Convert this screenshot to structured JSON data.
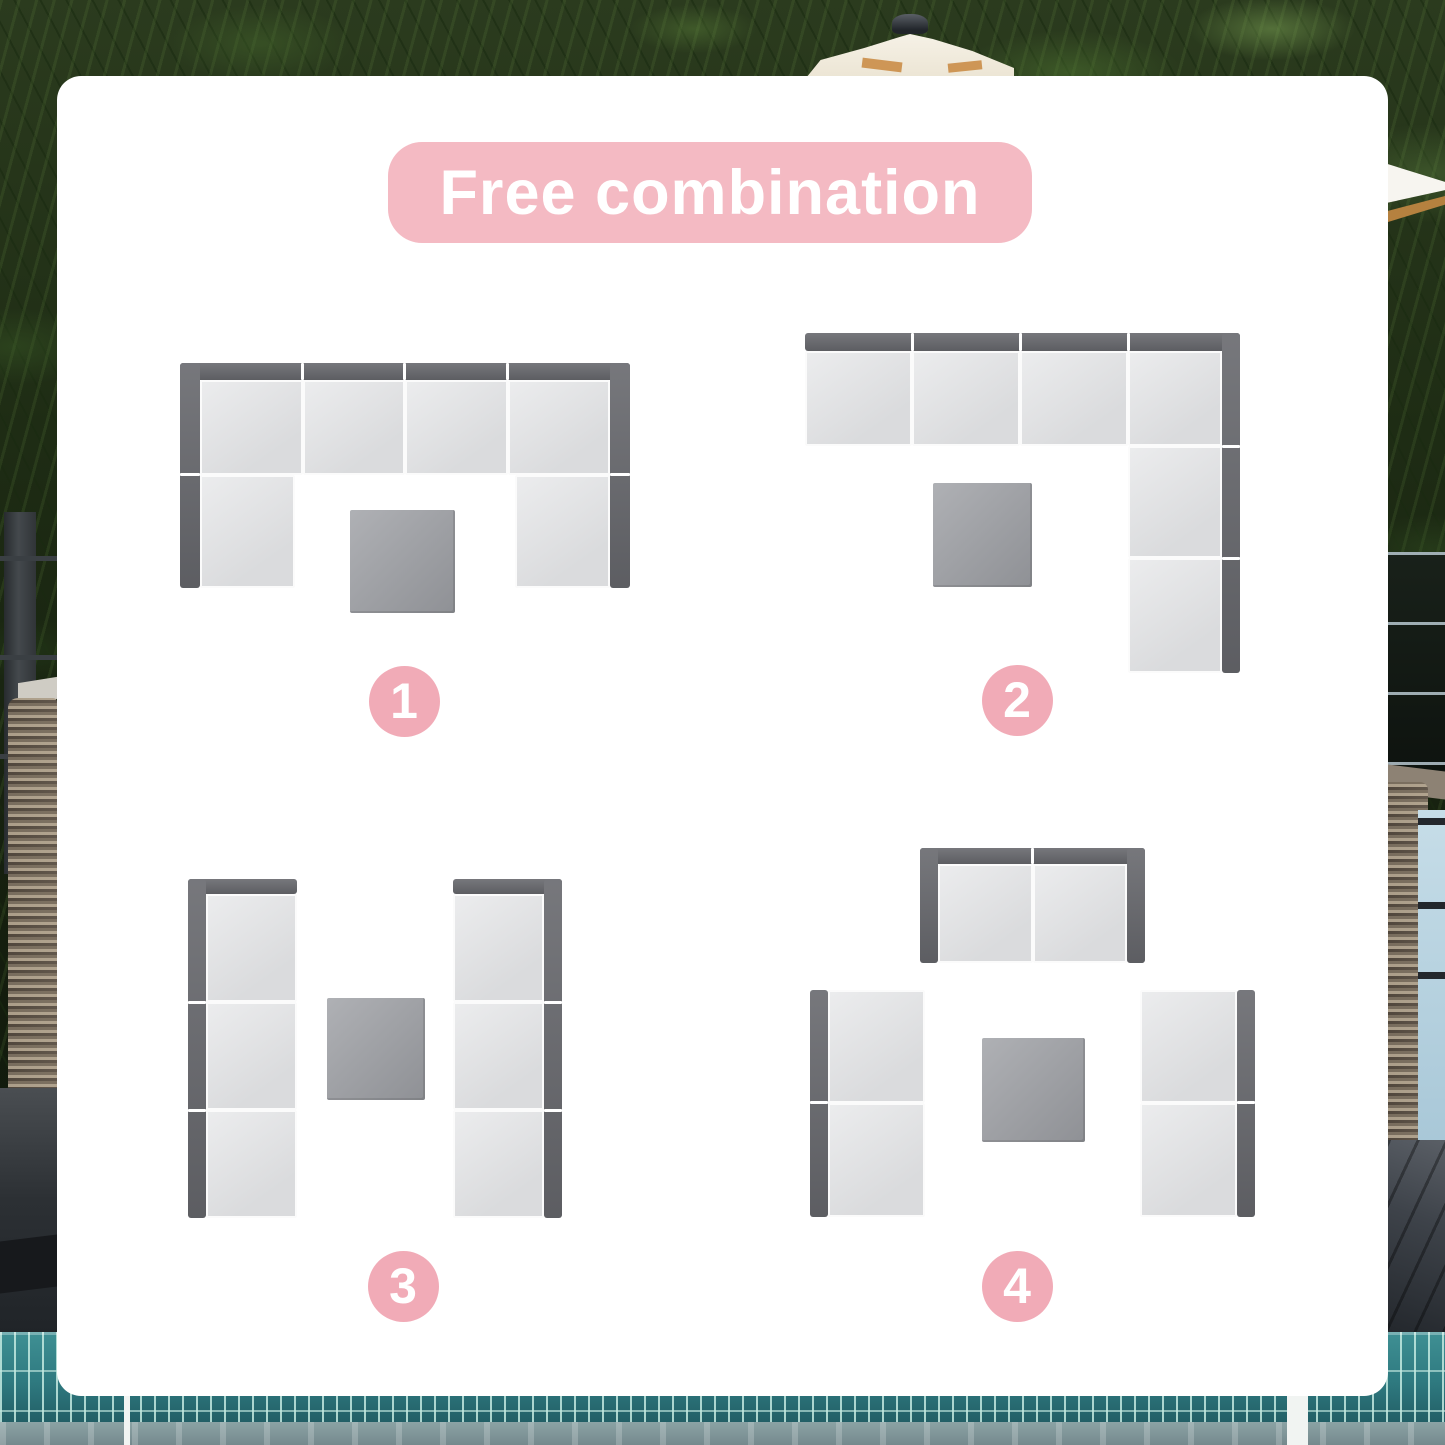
{
  "banner": {
    "label": "Free combination"
  },
  "colors": {
    "banner_bg": "#f4bac3",
    "banner_text": "#ffffff",
    "badge_bg": "#f1abb7",
    "badge_text": "#ffffff",
    "card_bg": "#ffffff",
    "sofa_frame": "#67686d",
    "sofa_cushion": "#e3e4e6",
    "cushion_seam": "#fbfbfb",
    "table_top": "#9b9da2",
    "pool_tile": "#2f7a80",
    "foliage": "#1d2b14"
  },
  "diagrams": [
    {
      "label": "1",
      "description": "U-shape: four-seat row with backrest, one seat down each side, table in the middle",
      "badge": {
        "cx": 404,
        "cy": 701,
        "d": 71
      },
      "parts": [
        {
          "kind": "frame",
          "name": "backrest-top",
          "x": 180,
          "y": 363,
          "w": 450,
          "h": 17
        },
        {
          "kind": "frame",
          "name": "armrest-left",
          "x": 180,
          "y": 363,
          "w": 20,
          "h": 225
        },
        {
          "kind": "frame",
          "name": "armrest-right",
          "x": 610,
          "y": 363,
          "w": 20,
          "h": 225
        },
        {
          "kind": "seam",
          "name": "frame-seam",
          "x": 301,
          "y": 363,
          "w": 3,
          "h": 17
        },
        {
          "kind": "seam",
          "name": "frame-seam",
          "x": 403,
          "y": 363,
          "w": 3,
          "h": 17
        },
        {
          "kind": "seam",
          "name": "frame-seam",
          "x": 506,
          "y": 363,
          "w": 3,
          "h": 17
        },
        {
          "kind": "seam",
          "name": "frame-seam",
          "x": 180,
          "y": 473,
          "w": 20,
          "h": 3
        },
        {
          "kind": "seam",
          "name": "frame-seam",
          "x": 610,
          "y": 473,
          "w": 20,
          "h": 3
        },
        {
          "kind": "cushion",
          "name": "seat-cushion",
          "x": 200,
          "y": 380,
          "w": 103,
          "h": 95
        },
        {
          "kind": "cushion",
          "name": "seat-cushion",
          "x": 303,
          "y": 380,
          "w": 102,
          "h": 95
        },
        {
          "kind": "cushion",
          "name": "seat-cushion",
          "x": 405,
          "y": 380,
          "w": 103,
          "h": 95
        },
        {
          "kind": "cushion",
          "name": "seat-cushion",
          "x": 508,
          "y": 380,
          "w": 102,
          "h": 95
        },
        {
          "kind": "cushion",
          "name": "seat-cushion",
          "x": 200,
          "y": 475,
          "w": 95,
          "h": 113
        },
        {
          "kind": "cushion",
          "name": "seat-cushion",
          "x": 515,
          "y": 475,
          "w": 95,
          "h": 113
        },
        {
          "kind": "table",
          "name": "coffee-table",
          "x": 350,
          "y": 510,
          "w": 105,
          "h": 103
        }
      ]
    },
    {
      "label": "2",
      "description": "L-shape: four-seat row with backrest plus two seats down the right side, table offset left",
      "badge": {
        "cx": 1017,
        "cy": 700,
        "d": 71
      },
      "parts": [
        {
          "kind": "frame",
          "name": "backrest-top",
          "x": 805,
          "y": 333,
          "w": 435,
          "h": 18
        },
        {
          "kind": "frame",
          "name": "backrest-right",
          "x": 1222,
          "y": 333,
          "w": 18,
          "h": 340
        },
        {
          "kind": "seam",
          "name": "frame-seam",
          "x": 911,
          "y": 333,
          "w": 3,
          "h": 18
        },
        {
          "kind": "seam",
          "name": "frame-seam",
          "x": 1019,
          "y": 333,
          "w": 3,
          "h": 18
        },
        {
          "kind": "seam",
          "name": "frame-seam",
          "x": 1127,
          "y": 333,
          "w": 3,
          "h": 18
        },
        {
          "kind": "seam",
          "name": "frame-seam",
          "x": 1222,
          "y": 445,
          "w": 18,
          "h": 3
        },
        {
          "kind": "seam",
          "name": "frame-seam",
          "x": 1222,
          "y": 557,
          "w": 18,
          "h": 3
        },
        {
          "kind": "cushion",
          "name": "seat-cushion",
          "x": 805,
          "y": 351,
          "w": 107,
          "h": 95
        },
        {
          "kind": "cushion",
          "name": "seat-cushion",
          "x": 912,
          "y": 351,
          "w": 108,
          "h": 95
        },
        {
          "kind": "cushion",
          "name": "seat-cushion",
          "x": 1020,
          "y": 351,
          "w": 108,
          "h": 95
        },
        {
          "kind": "cushion",
          "name": "corner-cushion",
          "x": 1128,
          "y": 351,
          "w": 94,
          "h": 95
        },
        {
          "kind": "cushion",
          "name": "seat-cushion",
          "x": 1128,
          "y": 446,
          "w": 94,
          "h": 112
        },
        {
          "kind": "cushion",
          "name": "seat-cushion",
          "x": 1128,
          "y": 558,
          "w": 94,
          "h": 115
        },
        {
          "kind": "table",
          "name": "coffee-table",
          "x": 933,
          "y": 483,
          "w": 99,
          "h": 104
        }
      ]
    },
    {
      "label": "3",
      "description": "Two facing three-seat sofas with table between",
      "badge": {
        "cx": 403,
        "cy": 1286,
        "d": 71
      },
      "parts": [
        {
          "kind": "frame",
          "name": "armrest-top-left-sofa",
          "x": 188,
          "y": 879,
          "w": 109,
          "h": 15
        },
        {
          "kind": "frame",
          "name": "backrest-left-sofa",
          "x": 188,
          "y": 879,
          "w": 18,
          "h": 339
        },
        {
          "kind": "frame",
          "name": "armrest-top-right-sofa",
          "x": 453,
          "y": 879,
          "w": 109,
          "h": 15
        },
        {
          "kind": "frame",
          "name": "backrest-right-sofa",
          "x": 544,
          "y": 879,
          "w": 18,
          "h": 339
        },
        {
          "kind": "seam",
          "name": "frame-seam",
          "x": 188,
          "y": 1001,
          "w": 18,
          "h": 3
        },
        {
          "kind": "seam",
          "name": "frame-seam",
          "x": 188,
          "y": 1109,
          "w": 18,
          "h": 3
        },
        {
          "kind": "seam",
          "name": "frame-seam",
          "x": 544,
          "y": 1001,
          "w": 18,
          "h": 3
        },
        {
          "kind": "seam",
          "name": "frame-seam",
          "x": 544,
          "y": 1109,
          "w": 18,
          "h": 3
        },
        {
          "kind": "cushion",
          "name": "seat-cushion",
          "x": 206,
          "y": 894,
          "w": 91,
          "h": 108
        },
        {
          "kind": "cushion",
          "name": "seat-cushion",
          "x": 206,
          "y": 1002,
          "w": 91,
          "h": 108
        },
        {
          "kind": "cushion",
          "name": "seat-cushion",
          "x": 206,
          "y": 1110,
          "w": 91,
          "h": 108
        },
        {
          "kind": "cushion",
          "name": "seat-cushion",
          "x": 453,
          "y": 894,
          "w": 91,
          "h": 108
        },
        {
          "kind": "cushion",
          "name": "seat-cushion",
          "x": 453,
          "y": 1002,
          "w": 91,
          "h": 108
        },
        {
          "kind": "cushion",
          "name": "seat-cushion",
          "x": 453,
          "y": 1110,
          "w": 91,
          "h": 108
        },
        {
          "kind": "table",
          "name": "coffee-table",
          "x": 327,
          "y": 998,
          "w": 98,
          "h": 102
        }
      ]
    },
    {
      "label": "4",
      "description": "Loveseat on top, two facing two-seat sofas below, table in the middle",
      "badge": {
        "cx": 1017,
        "cy": 1286,
        "d": 71
      },
      "parts": [
        {
          "kind": "frame",
          "name": "backrest-top",
          "x": 920,
          "y": 848,
          "w": 225,
          "h": 16
        },
        {
          "kind": "frame",
          "name": "armrest-left",
          "x": 920,
          "y": 848,
          "w": 18,
          "h": 115
        },
        {
          "kind": "frame",
          "name": "armrest-right",
          "x": 1127,
          "y": 848,
          "w": 18,
          "h": 115
        },
        {
          "kind": "frame",
          "name": "backrest-left-sofa",
          "x": 810,
          "y": 990,
          "w": 18,
          "h": 227
        },
        {
          "kind": "frame",
          "name": "backrest-right-sofa",
          "x": 1237,
          "y": 990,
          "w": 18,
          "h": 227
        },
        {
          "kind": "seam",
          "name": "frame-seam",
          "x": 1031,
          "y": 848,
          "w": 3,
          "h": 16
        },
        {
          "kind": "seam",
          "name": "frame-seam",
          "x": 810,
          "y": 1101,
          "w": 18,
          "h": 3
        },
        {
          "kind": "seam",
          "name": "frame-seam",
          "x": 1237,
          "y": 1101,
          "w": 18,
          "h": 3
        },
        {
          "kind": "cushion",
          "name": "seat-cushion",
          "x": 938,
          "y": 864,
          "w": 95,
          "h": 99
        },
        {
          "kind": "cushion",
          "name": "seat-cushion",
          "x": 1033,
          "y": 864,
          "w": 94,
          "h": 99
        },
        {
          "kind": "cushion",
          "name": "seat-cushion",
          "x": 828,
          "y": 990,
          "w": 97,
          "h": 113
        },
        {
          "kind": "cushion",
          "name": "seat-cushion",
          "x": 828,
          "y": 1103,
          "w": 97,
          "h": 114
        },
        {
          "kind": "cushion",
          "name": "seat-cushion",
          "x": 1140,
          "y": 990,
          "w": 97,
          "h": 113
        },
        {
          "kind": "cushion",
          "name": "seat-cushion",
          "x": 1140,
          "y": 1103,
          "w": 97,
          "h": 114
        },
        {
          "kind": "table",
          "name": "coffee-table",
          "x": 982,
          "y": 1038,
          "w": 103,
          "h": 104
        }
      ]
    }
  ]
}
